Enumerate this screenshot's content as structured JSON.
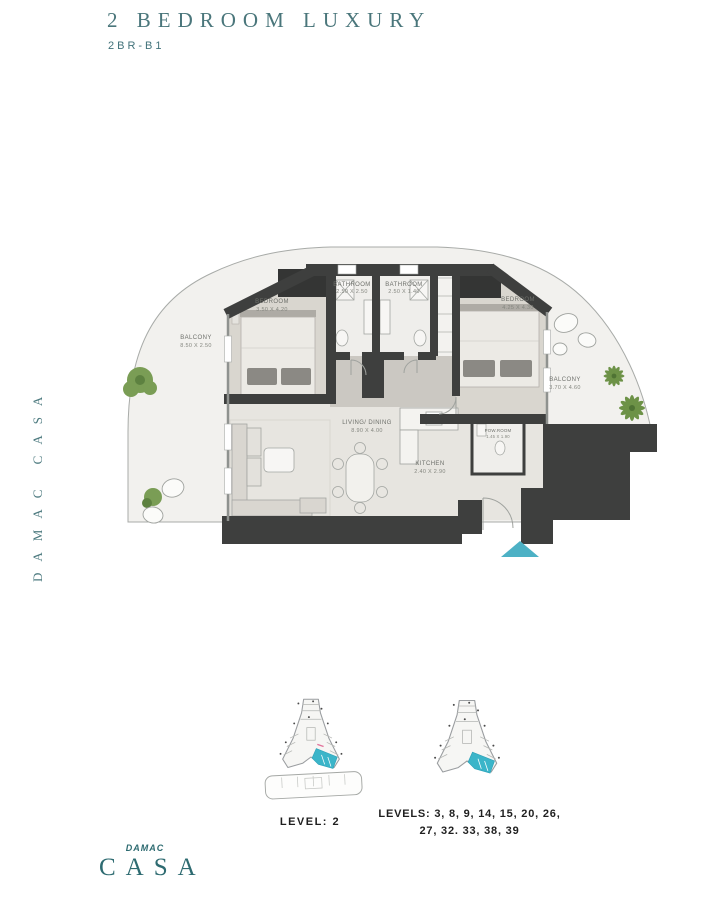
{
  "header": {
    "title": "2 BEDROOM LUXURY",
    "code": "2BR-B1"
  },
  "side_text": "DAMAC CASA",
  "rooms": {
    "bedroom1": {
      "label": "BEDROOM",
      "dims": "3.50 X 4.20"
    },
    "bathroom1": {
      "label": "BATHROOM",
      "dims": "2.50 X 2.50"
    },
    "bathroom2": {
      "label": "BATHROOM",
      "dims": "2.50 X 1.40"
    },
    "bedroom2": {
      "label": "BEDROOM",
      "dims": "4.25 X 4.30"
    },
    "balcony_left": {
      "label": "BALCONY",
      "dims": "8.50 X 2.50"
    },
    "balcony_right": {
      "label": "BALCONY",
      "dims": "3.70 X 4.60"
    },
    "living_dining": {
      "label": "LIVING/ DINING",
      "dims": "8.90 X 4.00"
    },
    "kitchen": {
      "label": "KITCHEN",
      "dims": "2.40 X 2.90"
    },
    "powder_room": {
      "label": "POW.ROOM",
      "dims": "1.45 X 1.90"
    }
  },
  "key_plans": {
    "left": {
      "caption": "LEVEL: 2"
    },
    "right": {
      "caption_line1": "LEVELS: 3, 8, 9, 14, 15, 20, 26,",
      "caption_line2": "27, 32. 33, 38, 39"
    }
  },
  "logo": {
    "brand": "DAMAC",
    "name": "CASA"
  },
  "colors": {
    "accent": "#4a767b",
    "wall": "#3e3f3e",
    "floor_beige": "#d9d6cf",
    "keyplan_highlight": "#3bb5c9",
    "entry_arrow": "#4db1c5",
    "plant_green": "#7a9d55"
  }
}
